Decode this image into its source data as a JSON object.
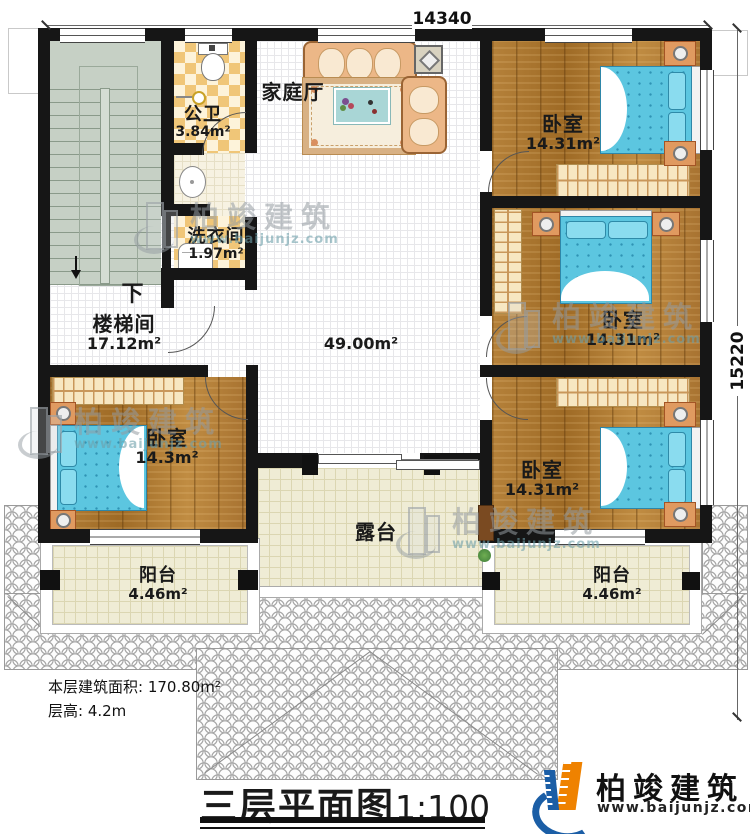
{
  "dimensions": {
    "top": "14340",
    "right": "15220"
  },
  "rooms": {
    "family_hall": {
      "name": "家庭厅"
    },
    "public_bath": {
      "name": "公卫",
      "area": "3.84m²"
    },
    "laundry": {
      "name": "洗衣间",
      "area": "1.97m²"
    },
    "stairwell": {
      "name": "楼梯间",
      "area": "17.12m²",
      "down": "下"
    },
    "hall": {
      "area": "49.00m²"
    },
    "bedroom_top_right": {
      "name": "卧室",
      "area": "14.31m²"
    },
    "bedroom_mid_right": {
      "name": "卧室",
      "area": "14.31m²"
    },
    "bedroom_bottom_right": {
      "name": "卧室",
      "area": "14.31m²"
    },
    "bedroom_left": {
      "name": "卧室",
      "area": "14.3m²"
    },
    "terrace": {
      "name": "露台"
    },
    "balcony_left": {
      "name": "阳台",
      "area": "4.46m²"
    },
    "balcony_right": {
      "name": "阳台",
      "area": "4.46m²"
    }
  },
  "notes": {
    "floor_area": "本层建筑面积: 170.80m²",
    "floor_height": "层高: 4.2m"
  },
  "title": {
    "text": "三层平面图",
    "scale": "1:100"
  },
  "brand": {
    "name": "柏竣建筑",
    "url": "www.baijunjz.com"
  },
  "colors": {
    "wall": "#161616",
    "wood": "#ad7930",
    "bed": "#5cc6e0",
    "logo_blue": "#1b5ea6",
    "logo_orange": "#ef8200"
  }
}
